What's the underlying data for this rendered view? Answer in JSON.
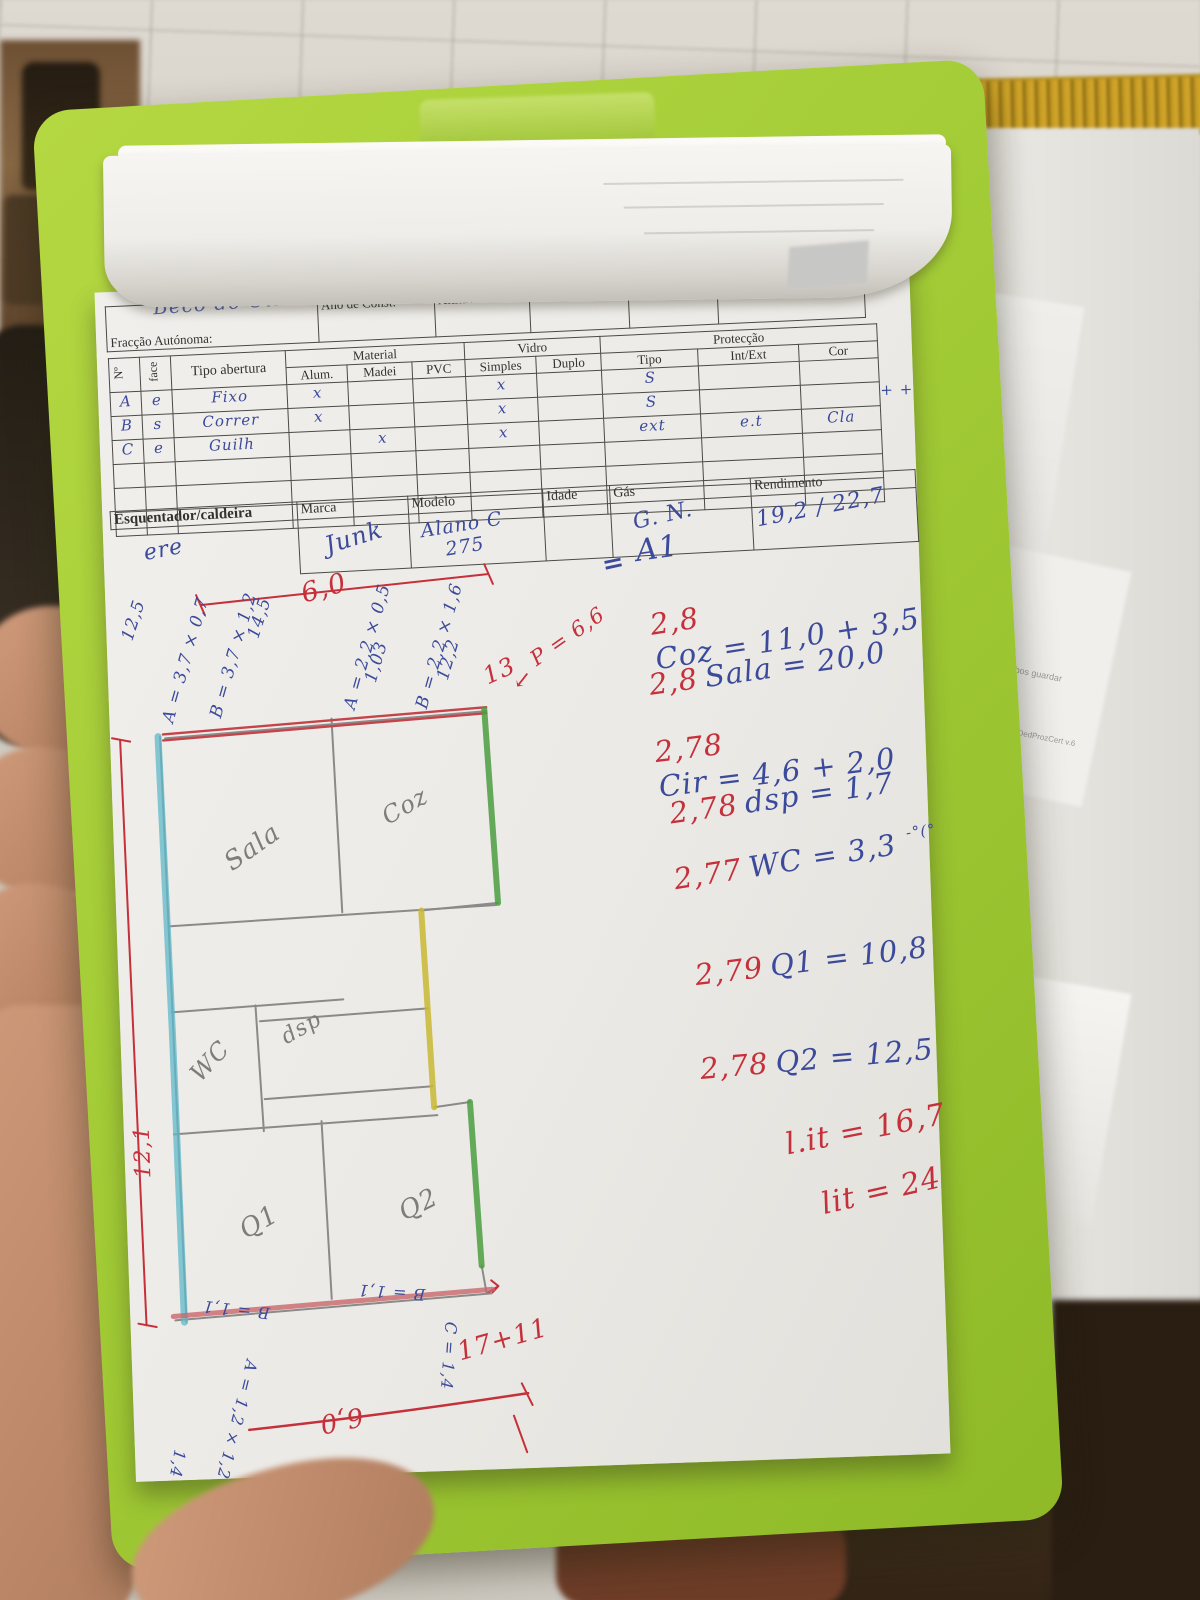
{
  "colors": {
    "clipboard_green": "#a4cd37",
    "red_ink": "#c5303a",
    "blue_ink": "#3b4a9b",
    "pencil_gray": "#7d7d7b",
    "cyan_highlight": "#5fb8c9",
    "green_highlight": "#4a9e3f",
    "yellow_highlight": "#c9b832"
  },
  "form_header": {
    "handwritten_name": "Beco do Olival",
    "fields": [
      "Fracção Autónoma:",
      "Ano de Const:",
      "Altitude:",
      "Pré.Frente?",
      "Elevador",
      "Pavimento e Cobertura"
    ]
  },
  "openings_table": {
    "col_no": "Nº",
    "col_face": "face",
    "col_tipo_abertura": "Tipo abertura",
    "group_material": "Material",
    "group_vidro": "Vidro",
    "group_proteccao": "Protecção",
    "sub_alum": "Alum.",
    "sub_madei": "Madei",
    "sub_pvc": "PVC",
    "sub_simples": "Simples",
    "sub_duplo": "Duplo",
    "sub_tipo": "Tipo",
    "sub_int_ext": "Int/Ext",
    "sub_cor": "Cor",
    "rows": [
      [
        "A",
        "e",
        "Fixo",
        "x",
        "",
        "",
        "x",
        "",
        "S",
        "",
        ""
      ],
      [
        "B",
        "s",
        "Correr",
        "x",
        "",
        "",
        "x",
        "",
        "S",
        "",
        ""
      ],
      [
        "C",
        "e",
        "Guilh",
        "",
        "x",
        "",
        "x",
        "",
        "ext",
        "e.t",
        "Cla"
      ]
    ],
    "margin_note": "+ +"
  },
  "heater_table": {
    "headers": [
      "Esquentador/caldeira",
      "Marca",
      "Modelo",
      "Idade",
      "Gás",
      "Rendimento"
    ],
    "values": [
      "ere",
      "Junk",
      "Alano C 275",
      "",
      "G. N.",
      "19,2 / 22,7"
    ]
  },
  "calc_notes": {
    "equals_mark": "=",
    "title": "A1",
    "lines": [
      {
        "red": "2,8",
        "blue": "Coz = 11,0 + 3,5"
      },
      {
        "red": "2,8",
        "blue": "Sala = 20,0"
      },
      {
        "red": "2,78",
        "blue": "Cir = 4,6 + 2,0"
      },
      {
        "red": "2,78",
        "blue": "dsp = 1,7"
      },
      {
        "red": "2,77",
        "blue": "WC = 3,3"
      },
      {
        "red": "2,79",
        "blue": "Q1 = 10,8"
      },
      {
        "red": "2,78",
        "blue": "Q2 = 12,5"
      }
    ],
    "wc_note": "-°(°",
    "totals": [
      "l.it = 16,7",
      "lit = 24"
    ]
  },
  "floor_plan": {
    "rooms": {
      "sala": "Sala",
      "coz": "Coz",
      "wc": "WC",
      "dsp": "dsp",
      "q1": "Q1",
      "q2": "Q2"
    },
    "dims": {
      "left_total": "12,1",
      "left_1": "12,5",
      "left_2": "A = 3,7 × 0,7",
      "left_3": "B = 3,7 × 1,2",
      "left_4": "14,5",
      "top_width": "6,0",
      "top_1": "A = 2,2 × 0,5",
      "top_2": "1,03",
      "top_3": "B = 2,2 × 1,6",
      "top_4": "12,2",
      "top_5": "13",
      "perimeter": "P = 6,6",
      "arrow": "↙",
      "bottom_b_left": "B = 1,1",
      "bottom_b_right": "B = 1,1",
      "bottom_c": "C = 1,4",
      "bottom_a": "A = 1,2 × 1,2",
      "bottom_1_4": "1,4",
      "bottom_width": "6,0",
      "bottom_sum": "17+11"
    }
  },
  "background": {
    "fine_print_1": "ambos guardar",
    "fine_print_2": "MobiDedProzCert v.6",
    "side_mark_1": "9",
    "side_mark_2": "35"
  }
}
